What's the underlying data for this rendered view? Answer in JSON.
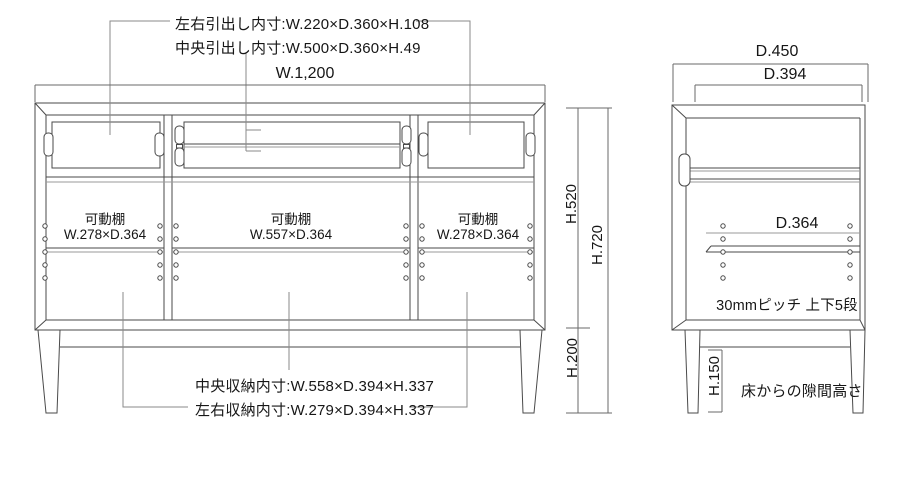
{
  "front_view": {
    "drawer_inner_notes": {
      "line1": "左右引出し内寸:W.220×D.360×H.108",
      "line2": "中央引出し内寸:W.500×D.360×H.49"
    },
    "width_dim": "W.1,200",
    "shelf_labels": [
      {
        "name": "可動棚",
        "size": "W.278×D.364"
      },
      {
        "name": "可動棚",
        "size": "W.557×D.364"
      },
      {
        "name": "可動棚",
        "size": "W.278×D.364"
      }
    ],
    "storage_notes": {
      "center": "中央収納内寸:W.558×D.394×H.337",
      "sides": "左右収納内寸:W.279×D.394×H.337"
    },
    "height_dims": {
      "carcass": "H.520",
      "total": "H.720",
      "legs": "H.200"
    }
  },
  "side_view": {
    "depth_dims": {
      "outer": "D.450",
      "inner": "D.394"
    },
    "shelf_depth": "D.364",
    "shelf_pitch_note": "30mmピッチ 上下5段",
    "floor_gap_dim": "H.150",
    "floor_gap_note": "床からの隙間高さ"
  },
  "colors": {
    "line": "#4a4a4a",
    "line_light": "#9a9a9a",
    "text": "#161616",
    "background": "#ffffff"
  }
}
